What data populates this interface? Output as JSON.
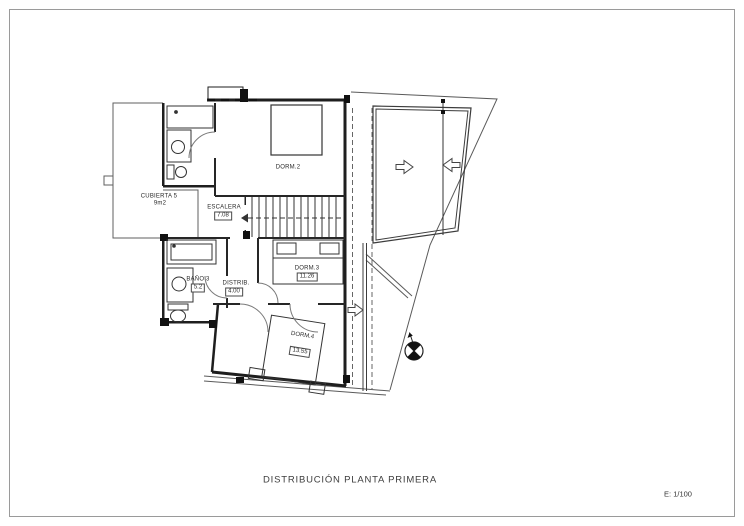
{
  "page": {
    "title": "DISTRIBUCIÓN PLANTA PRIMERA",
    "scale": "E: 1/100"
  },
  "rooms": {
    "cubierta5": {
      "name": "CUBIERTA 5",
      "area": "9m2"
    },
    "escalera": {
      "name": "ESCALERA",
      "area": "7.08"
    },
    "dorm2": {
      "name": "DORM.2"
    },
    "dorm3": {
      "name": "DORM.3",
      "area": "11.26"
    },
    "bano3": {
      "name": "BAÑO 3",
      "area": "5.2"
    },
    "distrib": {
      "name": "DISTRIB.",
      "area": "4.00"
    },
    "dorm4": {
      "name": "DORM.4",
      "area": "13.55"
    }
  },
  "icons": {
    "north_arrow": "north-arrow",
    "slope_arrow": "slope-arrow",
    "stairs_direction": "stairs-direction-arrow"
  },
  "colors": {
    "paper": "#ffffff",
    "wall": "#1e1e1e",
    "thin_line": "#555555",
    "frame": "#9a9a9a"
  }
}
